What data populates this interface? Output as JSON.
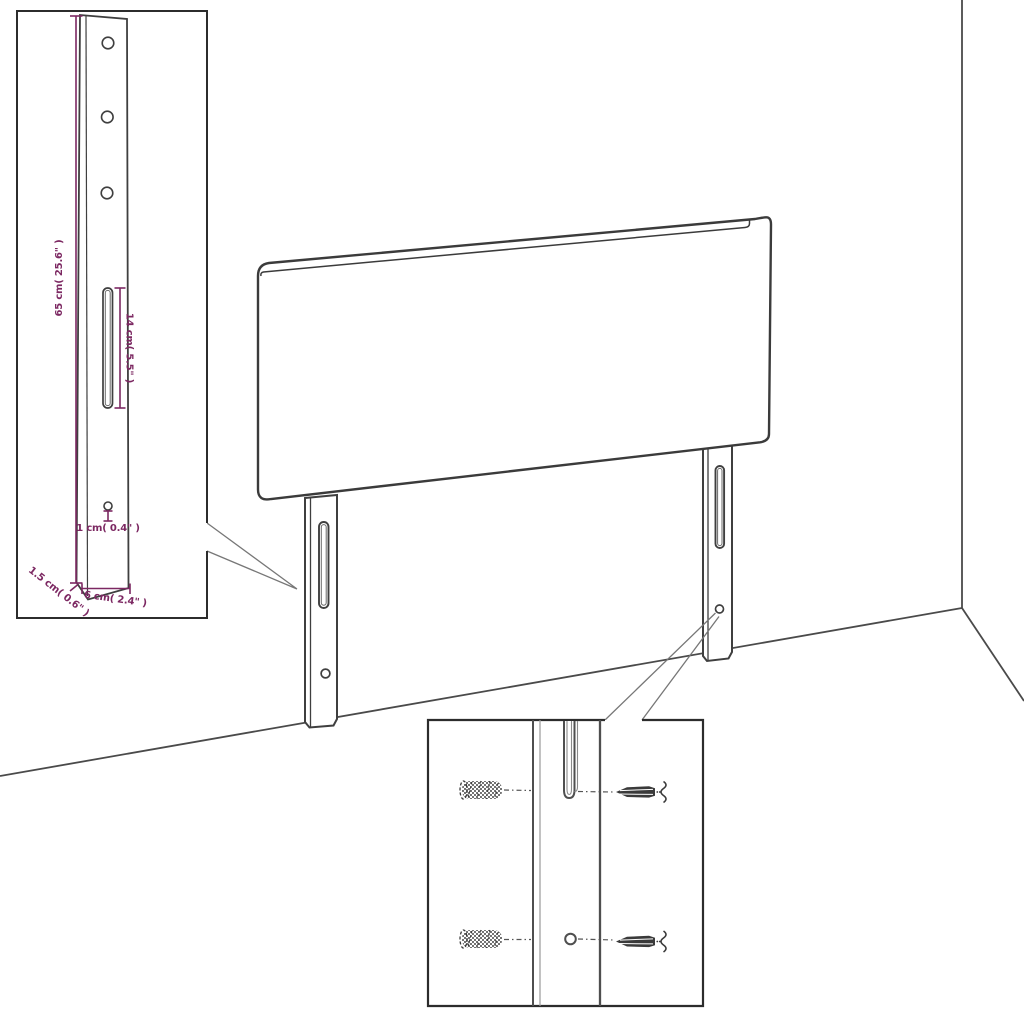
{
  "colors": {
    "drawing_line": "#3f3f3f",
    "wall_line": "#4a4a4a",
    "callout_line": "#777777",
    "dimension_accent": "#7c2862",
    "background": "#ffffff"
  },
  "bracket_inset": {
    "height_label": "65 cm( 25.6\" )",
    "slot_label": "14 cm( 5.5\" )",
    "hole_label": "1 cm( 0.4\" )",
    "thickness_label": "1.5 cm( 0.6\" )",
    "width_label": "6 cm( 2.4\" )"
  }
}
